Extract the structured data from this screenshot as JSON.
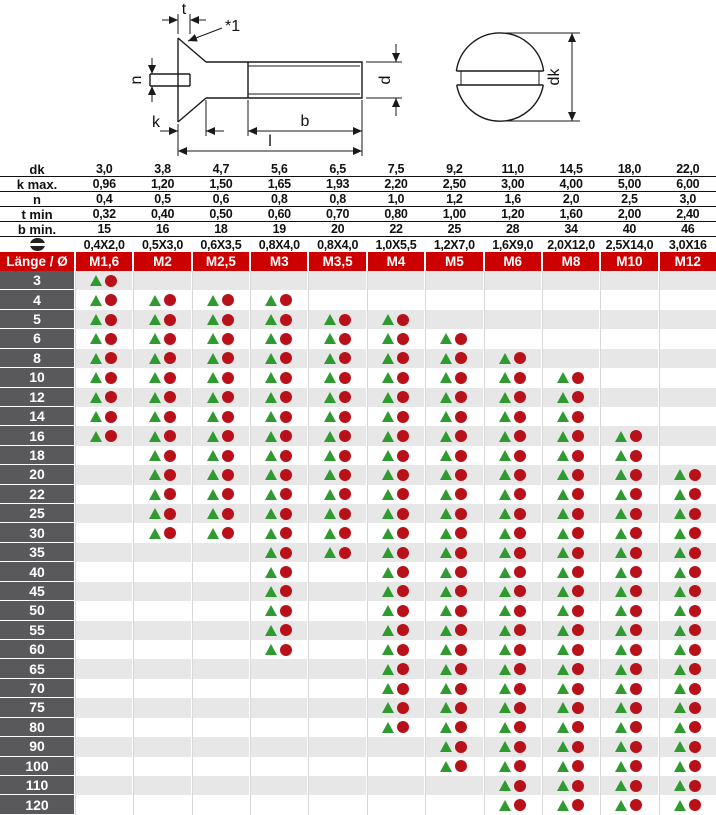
{
  "drawing": {
    "side_view_labels": {
      "t": "t",
      "note": "*1",
      "n": "n",
      "k": "k",
      "b": "b",
      "l": "l",
      "d": "d"
    },
    "top_view_labels": {
      "dk": "dk"
    }
  },
  "specs": {
    "rows": [
      {
        "key": "dk",
        "label": "dk",
        "values": [
          "3,0",
          "3,8",
          "4,7",
          "5,6",
          "6,5",
          "7,5",
          "9,2",
          "11,0",
          "14,5",
          "18,0",
          "22,0"
        ]
      },
      {
        "key": "k-max",
        "label": "k max.",
        "values": [
          "0,96",
          "1,20",
          "1,50",
          "1,65",
          "1,93",
          "2,20",
          "2,50",
          "3,00",
          "4,00",
          "5,00",
          "6,00"
        ]
      },
      {
        "key": "n",
        "label": "n",
        "values": [
          "0,4",
          "0,5",
          "0,6",
          "0,8",
          "0,8",
          "1,0",
          "1,2",
          "1,6",
          "2,0",
          "2,5",
          "3,0"
        ]
      },
      {
        "key": "t-min",
        "label": "t min",
        "values": [
          "0,32",
          "0,40",
          "0,50",
          "0,60",
          "0,70",
          "0,80",
          "1,00",
          "1,20",
          "1,60",
          "2,00",
          "2,40"
        ]
      },
      {
        "key": "b-min",
        "label": "b min.",
        "values": [
          "15",
          "16",
          "18",
          "19",
          "20",
          "22",
          "25",
          "28",
          "34",
          "40",
          "46"
        ]
      },
      {
        "key": "slot",
        "label": "",
        "icon": "slot-screw-icon",
        "values": [
          "0,4X2,0",
          "0,5X3,0",
          "0,6X3,5",
          "0,8X4,0",
          "0,8X4,0",
          "1,0X5,5",
          "1,2X7,0",
          "1,6X9,0",
          "2,0X12,0",
          "2,5X14,0",
          "3,0X16"
        ]
      }
    ]
  },
  "header": {
    "label": "Länge / Ø",
    "columns": [
      "M1,6",
      "M2",
      "M2,5",
      "M3",
      "M3,5",
      "M4",
      "M5",
      "M6",
      "M8",
      "M10",
      "M12"
    ]
  },
  "matrix": {
    "symbols": {
      "triangle": "available-triangle",
      "circle": "available-circle"
    },
    "rows": [
      {
        "length": "3",
        "cells": [
          1,
          0,
          0,
          0,
          0,
          0,
          0,
          0,
          0,
          0,
          0
        ]
      },
      {
        "length": "4",
        "cells": [
          1,
          1,
          1,
          1,
          0,
          0,
          0,
          0,
          0,
          0,
          0
        ]
      },
      {
        "length": "5",
        "cells": [
          1,
          1,
          1,
          1,
          1,
          1,
          0,
          0,
          0,
          0,
          0
        ]
      },
      {
        "length": "6",
        "cells": [
          1,
          1,
          1,
          1,
          1,
          1,
          1,
          0,
          0,
          0,
          0
        ]
      },
      {
        "length": "8",
        "cells": [
          1,
          1,
          1,
          1,
          1,
          1,
          1,
          1,
          0,
          0,
          0
        ]
      },
      {
        "length": "10",
        "cells": [
          1,
          1,
          1,
          1,
          1,
          1,
          1,
          1,
          1,
          0,
          0
        ]
      },
      {
        "length": "12",
        "cells": [
          1,
          1,
          1,
          1,
          1,
          1,
          1,
          1,
          1,
          0,
          0
        ]
      },
      {
        "length": "14",
        "cells": [
          1,
          1,
          1,
          1,
          1,
          1,
          1,
          1,
          1,
          0,
          0
        ]
      },
      {
        "length": "16",
        "cells": [
          1,
          1,
          1,
          1,
          1,
          1,
          1,
          1,
          1,
          1,
          0
        ]
      },
      {
        "length": "18",
        "cells": [
          0,
          1,
          1,
          1,
          1,
          1,
          1,
          1,
          1,
          1,
          0
        ]
      },
      {
        "length": "20",
        "cells": [
          0,
          1,
          1,
          1,
          1,
          1,
          1,
          1,
          1,
          1,
          1
        ]
      },
      {
        "length": "22",
        "cells": [
          0,
          1,
          1,
          1,
          1,
          1,
          1,
          1,
          1,
          1,
          1
        ]
      },
      {
        "length": "25",
        "cells": [
          0,
          1,
          1,
          1,
          1,
          1,
          1,
          1,
          1,
          1,
          1
        ]
      },
      {
        "length": "30",
        "cells": [
          0,
          1,
          1,
          1,
          1,
          1,
          1,
          1,
          1,
          1,
          1
        ]
      },
      {
        "length": "35",
        "cells": [
          0,
          0,
          0,
          1,
          1,
          1,
          1,
          1,
          1,
          1,
          1
        ]
      },
      {
        "length": "40",
        "cells": [
          0,
          0,
          0,
          1,
          0,
          1,
          1,
          1,
          1,
          1,
          1
        ]
      },
      {
        "length": "45",
        "cells": [
          0,
          0,
          0,
          1,
          0,
          1,
          1,
          1,
          1,
          1,
          1
        ]
      },
      {
        "length": "50",
        "cells": [
          0,
          0,
          0,
          1,
          0,
          1,
          1,
          1,
          1,
          1,
          1
        ]
      },
      {
        "length": "55",
        "cells": [
          0,
          0,
          0,
          1,
          0,
          1,
          1,
          1,
          1,
          1,
          1
        ]
      },
      {
        "length": "60",
        "cells": [
          0,
          0,
          0,
          1,
          0,
          1,
          1,
          1,
          1,
          1,
          1
        ]
      },
      {
        "length": "65",
        "cells": [
          0,
          0,
          0,
          0,
          0,
          1,
          1,
          1,
          1,
          1,
          1
        ]
      },
      {
        "length": "70",
        "cells": [
          0,
          0,
          0,
          0,
          0,
          1,
          1,
          1,
          1,
          1,
          1
        ]
      },
      {
        "length": "75",
        "cells": [
          0,
          0,
          0,
          0,
          0,
          1,
          1,
          1,
          1,
          1,
          1
        ]
      },
      {
        "length": "80",
        "cells": [
          0,
          0,
          0,
          0,
          0,
          1,
          1,
          1,
          1,
          1,
          1
        ]
      },
      {
        "length": "90",
        "cells": [
          0,
          0,
          0,
          0,
          0,
          0,
          1,
          1,
          1,
          1,
          1
        ]
      },
      {
        "length": "100",
        "cells": [
          0,
          0,
          0,
          0,
          0,
          0,
          1,
          1,
          1,
          1,
          1
        ]
      },
      {
        "length": "110",
        "cells": [
          0,
          0,
          0,
          0,
          0,
          0,
          0,
          1,
          1,
          1,
          1
        ]
      },
      {
        "length": "120",
        "cells": [
          0,
          0,
          0,
          0,
          0,
          0,
          0,
          1,
          1,
          1,
          1
        ]
      }
    ]
  },
  "colors": {
    "header_red": "#cc0000",
    "label_gray": "#59595b",
    "row_alt": "#e7e7e7",
    "triangle_green": "#2f9a30",
    "circle_red": "#b8111a"
  }
}
